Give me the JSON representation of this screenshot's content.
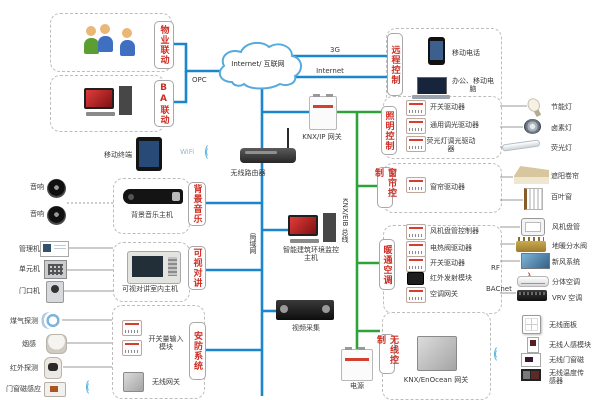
{
  "colors": {
    "line_blue": "#1b86cb",
    "line_green": "#2fa33a",
    "label_red": "#cf2f26",
    "dashed_border": "#bdbdbd"
  },
  "cloud": {
    "label": "Internet/ 互联网"
  },
  "link_labels": {
    "g3": "3G",
    "internet": "Internet",
    "opc": "OPC",
    "wifi": "WiFi",
    "lan": "局域网",
    "knx_bus": "KNX/EIB 总线",
    "rf": "RF",
    "bacnet": "BACnet"
  },
  "center": {
    "router": "无线路由器",
    "tablet": "移动终端",
    "knx_ip_gateway": "KNX/IP 网关",
    "building_host": "智能建筑环境监控主机",
    "video_capture": "视频采集",
    "power": "电源"
  },
  "groups": {
    "property": {
      "label": "物业联动"
    },
    "ba": {
      "label": "BA联动"
    },
    "remote": {
      "label": "远程控制",
      "items": [
        "移动电话",
        "办公、移动电脑"
      ]
    },
    "lighting": {
      "label": "照明控制",
      "items": [
        "开关驱动器",
        "通用调光驱动器",
        "荧光灯调光驱动器"
      ]
    },
    "curtain": {
      "label": "窗帘控制",
      "items": [
        "窗帘驱动器"
      ]
    },
    "hvac": {
      "label": "暖通空调",
      "items": [
        "风机盘管控制器",
        "电热阀驱动器",
        "开关驱动器",
        "红外发射模块",
        "空调网关"
      ]
    },
    "wireless": {
      "label": "无线控制",
      "items": [
        "KNX/EnOcean 网关"
      ]
    },
    "music": {
      "label": "背景音乐",
      "items": [
        "背景音乐主机"
      ]
    },
    "intercom": {
      "label": "可视对讲",
      "items": [
        "可视对讲室内主机"
      ]
    },
    "security": {
      "label": "安防系统",
      "items": [
        "开关量输入模块",
        "无线网关"
      ]
    }
  },
  "left_devices": [
    "音响",
    "音响",
    "管理机",
    "单元机",
    "门口机",
    "煤气探测",
    "烟感",
    "红外探测",
    "门窗磁感应"
  ],
  "right_devices": [
    "节能灯",
    "卤素灯",
    "荧光灯",
    "遮阳卷帘",
    "百叶窗",
    "风机盘管",
    "地暖分水阀",
    "新风系统",
    "分体空调",
    "VRV 空调",
    "无线面板",
    "无线人感模块",
    "无线门窗磁",
    "无线温度传感器"
  ]
}
